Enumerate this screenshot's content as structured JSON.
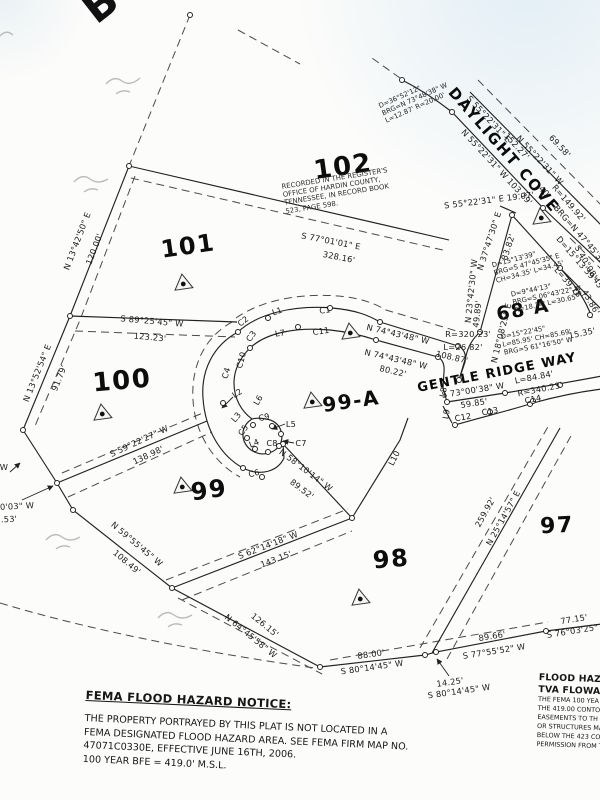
{
  "corner_letter": "B",
  "roads": [
    {
      "name": "DAYLIGHT COVE"
    },
    {
      "name": "GENTLE RIDGE WAY"
    }
  ],
  "recorded_note": {
    "lines": [
      "RECORDED IN THE REGISTER'S",
      "OFFICE OF HARDIN COUNTY,",
      "TENNESSEE, IN RECORD BOOK",
      "523, PAGE 598."
    ]
  },
  "fema_notice": {
    "title": "FEMA FLOOD HAZARD NOTICE:",
    "lines": [
      "THE PROPERTY PORTRAYED BY THIS PLAT IS NOT LOCATED IN A",
      "FEMA DESIGNATED FLOOD HAZARD AREA. SEE FEMA FIRM MAP NO.",
      "47071C0330E, EFFECTIVE JUNE 16TH, 2006.",
      "100 YEAR BFE = 419.0' M.S.L."
    ]
  },
  "flood_note": {
    "heading_lines": [
      "FLOOD HAZA",
      "TVA FLOWAG"
    ],
    "lines": [
      "THE FEMA 100 YEA",
      "THE 419.00 CONTOU",
      "EASEMENTS TO TH",
      "OR STRUCTURES MA",
      "BELOW THE 423 CO",
      "PERMISSION FROM T"
    ]
  },
  "lots": [
    {
      "t": "102",
      "x": 343,
      "y": 167,
      "fs": 26,
      "r": -8
    },
    {
      "t": "101",
      "x": 188,
      "y": 246,
      "fs": 24,
      "r": -8
    },
    {
      "t": "100",
      "x": 122,
      "y": 381,
      "fs": 26,
      "r": -5
    },
    {
      "t": "99",
      "x": 209,
      "y": 490,
      "fs": 24,
      "r": -8
    },
    {
      "t": "99-A",
      "x": 351,
      "y": 401,
      "fs": 20,
      "r": -8
    },
    {
      "t": "98",
      "x": 391,
      "y": 559,
      "fs": 24,
      "r": -5
    },
    {
      "t": "97",
      "x": 557,
      "y": 526,
      "fs": 22,
      "r": -3
    },
    {
      "t": "68 A",
      "x": 523,
      "y": 310,
      "fs": 19,
      "r": -10
    }
  ],
  "labels": [
    {
      "t": "N 13°42'50\" E",
      "x": 77,
      "y": 241,
      "r": -69
    },
    {
      "t": "120.00'",
      "x": 94,
      "y": 249,
      "r": -69
    },
    {
      "t": "N 13°52'54\" E",
      "x": 37,
      "y": 373,
      "r": -68
    },
    {
      "t": "91.79'",
      "x": 59,
      "y": 378,
      "r": -68
    },
    {
      "t": "S 89°25'45\" W",
      "x": 152,
      "y": 321,
      "r": 5
    },
    {
      "t": "123.23'",
      "x": 150,
      "y": 337,
      "r": 5
    },
    {
      "t": "S 77°01'01\" E",
      "x": 331,
      "y": 241,
      "r": 11
    },
    {
      "t": "328.16'",
      "x": 339,
      "y": 257,
      "r": 11
    },
    {
      "t": "N 74°43'48\" W",
      "x": 398,
      "y": 334,
      "r": 13
    },
    {
      "t": "108.87'",
      "x": 452,
      "y": 357,
      "r": 13
    },
    {
      "t": "N 74°43'48\" W",
      "x": 396,
      "y": 359,
      "r": 13
    },
    {
      "t": "80.22'",
      "x": 393,
      "y": 371,
      "r": 13
    },
    {
      "t": "S 73°00'38\" W",
      "x": 473,
      "y": 390,
      "r": -9
    },
    {
      "t": "59.85'",
      "x": 474,
      "y": 403,
      "r": -9
    },
    {
      "t": "L=84.84'",
      "x": 534,
      "y": 377,
      "r": -11
    },
    {
      "t": "R=340.23'",
      "x": 540,
      "y": 389,
      "r": -11
    },
    {
      "t": "R=320.23'",
      "x": 468,
      "y": 334,
      "r": 0
    },
    {
      "t": "L=26.82'",
      "x": 463,
      "y": 347,
      "r": 0
    },
    {
      "t": "S 59°22'27\" W",
      "x": 139,
      "y": 441,
      "r": -25
    },
    {
      "t": "138.98'",
      "x": 148,
      "y": 455,
      "r": -25
    },
    {
      "t": "N 59°55'45\" W",
      "x": 137,
      "y": 544,
      "r": 40
    },
    {
      "t": "108.49'",
      "x": 127,
      "y": 562,
      "r": 40
    },
    {
      "t": "S 62°14'18\" W",
      "x": 268,
      "y": 545,
      "r": -21
    },
    {
      "t": "143.15'",
      "x": 276,
      "y": 559,
      "r": -21
    },
    {
      "t": "N 64°45'58\" W",
      "x": 251,
      "y": 636,
      "r": 39
    },
    {
      "t": "126.15'",
      "x": 265,
      "y": 625,
      "r": 39
    },
    {
      "t": "88.00'",
      "x": 371,
      "y": 654,
      "r": -8
    },
    {
      "t": "S 80°14'45\" W",
      "x": 372,
      "y": 667,
      "r": -8
    },
    {
      "t": "14.25'",
      "x": 450,
      "y": 682,
      "r": -8
    },
    {
      "t": "S 80°14'45\" W",
      "x": 459,
      "y": 691,
      "r": -8
    },
    {
      "t": "89.66'",
      "x": 492,
      "y": 636,
      "r": -9
    },
    {
      "t": "S 77°55'52\" W",
      "x": 494,
      "y": 651,
      "r": -9
    },
    {
      "t": "77.15'",
      "x": 574,
      "y": 619,
      "r": -9
    },
    {
      "t": "S 76°03'25\" W",
      "x": 578,
      "y": 630,
      "r": -9
    },
    {
      "t": "259.92'",
      "x": 485,
      "y": 512,
      "r": -61
    },
    {
      "t": "N 25°14'57\" E",
      "x": 503,
      "y": 518,
      "r": -61
    },
    {
      "t": "N 58°10'14\" W",
      "x": 306,
      "y": 470,
      "r": 37
    },
    {
      "t": "89.52'",
      "x": 302,
      "y": 489,
      "r": 37
    },
    {
      "t": "N 55°22'31\" W  103.79'",
      "x": 497,
      "y": 167,
      "r": 47
    },
    {
      "t": "S 55°22'31\" E",
      "x": 489,
      "y": 119,
      "r": 47
    },
    {
      "t": "152.27'",
      "x": 517,
      "y": 146,
      "r": 47
    },
    {
      "t": "N 55°22'31\" W",
      "x": 540,
      "y": 160,
      "r": 47
    },
    {
      "t": "69.58'",
      "x": 560,
      "y": 146,
      "r": 47
    },
    {
      "t": "S 55°22'31\" E  19.07'",
      "x": 489,
      "y": 200,
      "r": -7
    },
    {
      "t": "40'",
      "x": 545,
      "y": 192,
      "r": 47
    },
    {
      "t": "N 37°47'30\" E",
      "x": 489,
      "y": 241,
      "r": -72
    },
    {
      "t": "83.82'",
      "x": 508,
      "y": 247,
      "r": -72
    },
    {
      "t": "N 23°42'30\" W",
      "x": 471,
      "y": 291,
      "r": -84
    },
    {
      "t": "49.89'",
      "x": 477,
      "y": 314,
      "r": -84
    },
    {
      "t": "N 18°08'25\" E",
      "x": 501,
      "y": 333,
      "r": -76
    },
    {
      "t": "15.35'",
      "x": 582,
      "y": 333,
      "r": -12
    },
    {
      "t": "R=149.92'",
      "x": 569,
      "y": 203,
      "r": 49
    },
    {
      "t": "BRG=N 47°45'35\" W",
      "x": 585,
      "y": 240,
      "r": 49
    },
    {
      "t": "D=15°13'39\"",
      "x": 577,
      "y": 259,
      "r": 49
    },
    {
      "t": "L=39.78'",
      "x": 569,
      "y": 283,
      "r": 49
    },
    {
      "t": "S 40°08'45\" E",
      "x": 592,
      "y": 272,
      "r": 60
    },
    {
      "t": "43.86'",
      "x": 591,
      "y": 302,
      "r": 60
    },
    {
      "t": "W",
      "x": 4,
      "y": 467,
      "r": 0
    },
    {
      "t": "0'03\" W",
      "x": 17,
      "y": 506,
      "r": -3
    },
    {
      "t": ".53'",
      "x": 9,
      "y": 519,
      "r": -3
    }
  ],
  "curve_tags": [
    {
      "t": "C1",
      "x": 325,
      "y": 310,
      "r": -8
    },
    {
      "t": "L1",
      "x": 277,
      "y": 311,
      "r": -18
    },
    {
      "t": "C2",
      "x": 243,
      "y": 321,
      "r": -38
    },
    {
      "t": "C3",
      "x": 251,
      "y": 336,
      "r": -55
    },
    {
      "t": "L7",
      "x": 280,
      "y": 333,
      "r": -8
    },
    {
      "t": "C11",
      "x": 321,
      "y": 331,
      "r": -8
    },
    {
      "t": "C10",
      "x": 241,
      "y": 360,
      "r": -75
    },
    {
      "t": "C4",
      "x": 226,
      "y": 373,
      "r": -72
    },
    {
      "t": "L2",
      "x": 237,
      "y": 393,
      "r": -33
    },
    {
      "t": "L6",
      "x": 258,
      "y": 400,
      "r": -60
    },
    {
      "t": "L3",
      "x": 236,
      "y": 417,
      "r": -50
    },
    {
      "t": "C5",
      "x": 243,
      "y": 430,
      "r": -55
    },
    {
      "t": "C9",
      "x": 264,
      "y": 417,
      "r": -12
    },
    {
      "t": "L5",
      "x": 291,
      "y": 424,
      "r": 0
    },
    {
      "t": "L4",
      "x": 254,
      "y": 443,
      "r": -22
    },
    {
      "t": "C8",
      "x": 272,
      "y": 443,
      "r": 0
    },
    {
      "t": "C7",
      "x": 301,
      "y": 443,
      "r": 0
    },
    {
      "t": "C6",
      "x": 254,
      "y": 473,
      "r": -15
    },
    {
      "t": "L8",
      "x": 443,
      "y": 392,
      "r": -80
    },
    {
      "t": "L9",
      "x": 446,
      "y": 414,
      "r": -80
    },
    {
      "t": "L10",
      "x": 394,
      "y": 458,
      "r": -63
    },
    {
      "t": "C12",
      "x": 463,
      "y": 417,
      "r": -10
    },
    {
      "t": "C13",
      "x": 490,
      "y": 411,
      "r": -10
    },
    {
      "t": "C14",
      "x": 533,
      "y": 399,
      "r": -12
    }
  ],
  "callouts": [
    {
      "x": 415,
      "y": 100,
      "r": -24,
      "lines": [
        "D=36°52'12\"",
        "BRG=N 73°48'38\" W",
        "L=12.87' R=20.00'"
      ]
    },
    {
      "x": 528,
      "y": 265,
      "r": -15,
      "lines": [
        "D=15°13'39\"",
        "BRG=S 47°45'35\" E",
        "CH=34.35' L=34.45'"
      ]
    },
    {
      "x": 547,
      "y": 296,
      "r": -12,
      "lines": [
        "D=9°44'13\"",
        "BRG=S 06°43'22\" W",
        "R=18.74' L=30.65'"
      ]
    },
    {
      "x": 537,
      "y": 339,
      "r": -11,
      "lines": [
        "D=15°22'45\"",
        "L=85.95' CH=85.69'",
        "BRG=S 61°16'50\" W"
      ]
    }
  ],
  "markers": [
    {
      "x": 183,
      "y": 282
    },
    {
      "x": 350,
      "y": 331
    },
    {
      "x": 312,
      "y": 400
    },
    {
      "x": 102,
      "y": 412
    },
    {
      "x": 182,
      "y": 485
    },
    {
      "x": 360,
      "y": 597
    },
    {
      "x": 541,
      "y": 216
    }
  ],
  "vertices": [
    {
      "x": 129,
      "y": 166
    },
    {
      "x": 70,
      "y": 316
    },
    {
      "x": 23,
      "y": 430
    },
    {
      "x": 57,
      "y": 483
    },
    {
      "x": 73,
      "y": 510
    },
    {
      "x": 172,
      "y": 588
    },
    {
      "x": 320,
      "y": 667
    },
    {
      "x": 425,
      "y": 655
    },
    {
      "x": 436,
      "y": 652
    },
    {
      "x": 546,
      "y": 631
    },
    {
      "x": 352,
      "y": 518
    },
    {
      "x": 283,
      "y": 444
    },
    {
      "x": 238,
      "y": 332
    },
    {
      "x": 268,
      "y": 318
    },
    {
      "x": 330,
      "y": 308
    },
    {
      "x": 380,
      "y": 322
    },
    {
      "x": 458,
      "y": 346
    },
    {
      "x": 250,
      "y": 348
    },
    {
      "x": 298,
      "y": 327
    },
    {
      "x": 376,
      "y": 340
    },
    {
      "x": 438,
      "y": 357
    },
    {
      "x": 447,
      "y": 402
    },
    {
      "x": 455,
      "y": 425
    },
    {
      "x": 505,
      "y": 393
    },
    {
      "x": 530,
      "y": 404
    },
    {
      "x": 560,
      "y": 385
    },
    {
      "x": 490,
      "y": 412
    },
    {
      "x": 533,
      "y": 401
    },
    {
      "x": 452,
      "y": 112
    },
    {
      "x": 402,
      "y": 80
    },
    {
      "x": 543,
      "y": 208
    },
    {
      "x": 512,
      "y": 215
    },
    {
      "x": 480,
      "y": 332
    },
    {
      "x": 459,
      "y": 380
    },
    {
      "x": 223,
      "y": 403
    },
    {
      "x": 243,
      "y": 468
    },
    {
      "x": 262,
      "y": 477
    },
    {
      "x": 253,
      "y": 425
    },
    {
      "x": 247,
      "y": 438
    },
    {
      "x": 255,
      "y": 449
    },
    {
      "x": 268,
      "y": 452
    },
    {
      "x": 279,
      "y": 446
    },
    {
      "x": 281,
      "y": 434
    },
    {
      "x": 272,
      "y": 426
    },
    {
      "x": 560,
      "y": 268
    },
    {
      "x": 576,
      "y": 292
    },
    {
      "x": 590,
      "y": 315
    },
    {
      "x": 190,
      "y": 15
    }
  ]
}
